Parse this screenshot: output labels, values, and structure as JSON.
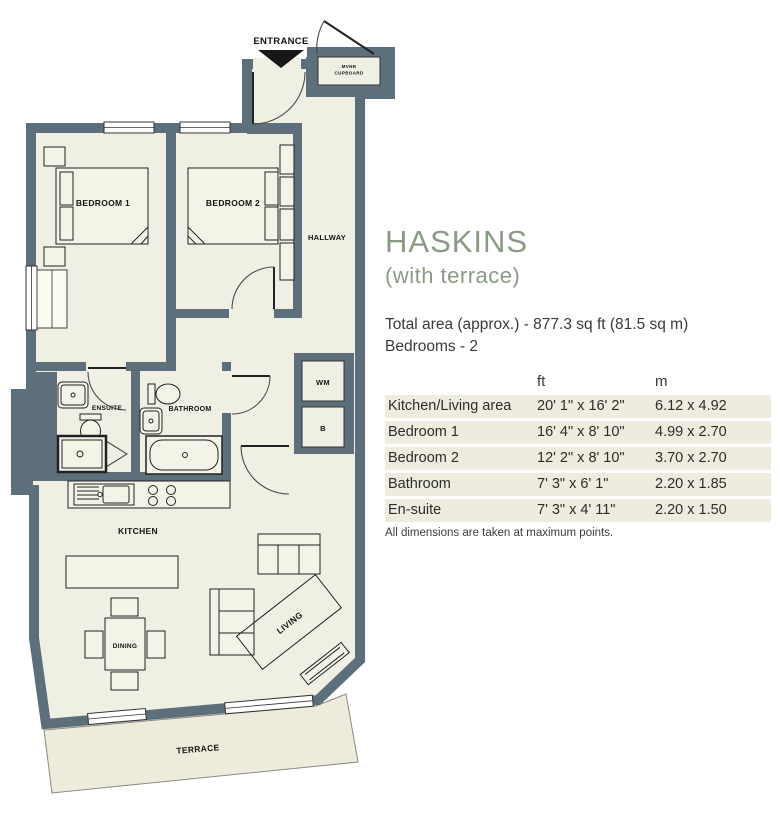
{
  "info": {
    "title": "HASKINS",
    "subtitle": "(with terrace)",
    "total_area": "Total area (approx.) - 877.3 sq ft (81.5 sq m)",
    "bedrooms": "Bedrooms - 2",
    "note": "All dimensions are taken at maximum points."
  },
  "dimensions_table": {
    "headers": {
      "name": "",
      "ft": "ft",
      "m": "m"
    },
    "rows": [
      {
        "name": "Kitchen/Living area",
        "ft": "20' 1\" x 16' 2\"",
        "m": "6.12 x 4.92"
      },
      {
        "name": "Bedroom 1",
        "ft": "16' 4\" x 8' 10\"",
        "m": "4.99 x 2.70"
      },
      {
        "name": "Bedroom 2",
        "ft": "12' 2\" x 8' 10\"",
        "m": "3.70 x 2.70"
      },
      {
        "name": "Bathroom",
        "ft": "7' 3\" x 6' 1\"",
        "m": "2.20 x 1.85"
      },
      {
        "name": "En-suite",
        "ft": "7' 3\" x 4' 11\"",
        "m": "2.20 x 1.50"
      }
    ]
  },
  "floorplan": {
    "labels": {
      "entrance": "ENTRANCE",
      "cupboard_line1": "MVHR",
      "cupboard_line2": "CUPBOARD",
      "hallway": "HALLWAY",
      "bedroom1": "BEDROOM 1",
      "bedroom2": "BEDROOM 2",
      "ensuite": "ENSUITE",
      "bathroom": "BATHROOM",
      "wm": "WM",
      "b": "B",
      "kitchen": "KITCHEN",
      "dining": "DINING",
      "living": "LIVING",
      "terrace": "TERRACE"
    },
    "colors": {
      "wall": "#5e6f7c",
      "floor": "#f0efe3",
      "terrace": "#edecdc",
      "accent": "#8a9a84"
    }
  }
}
